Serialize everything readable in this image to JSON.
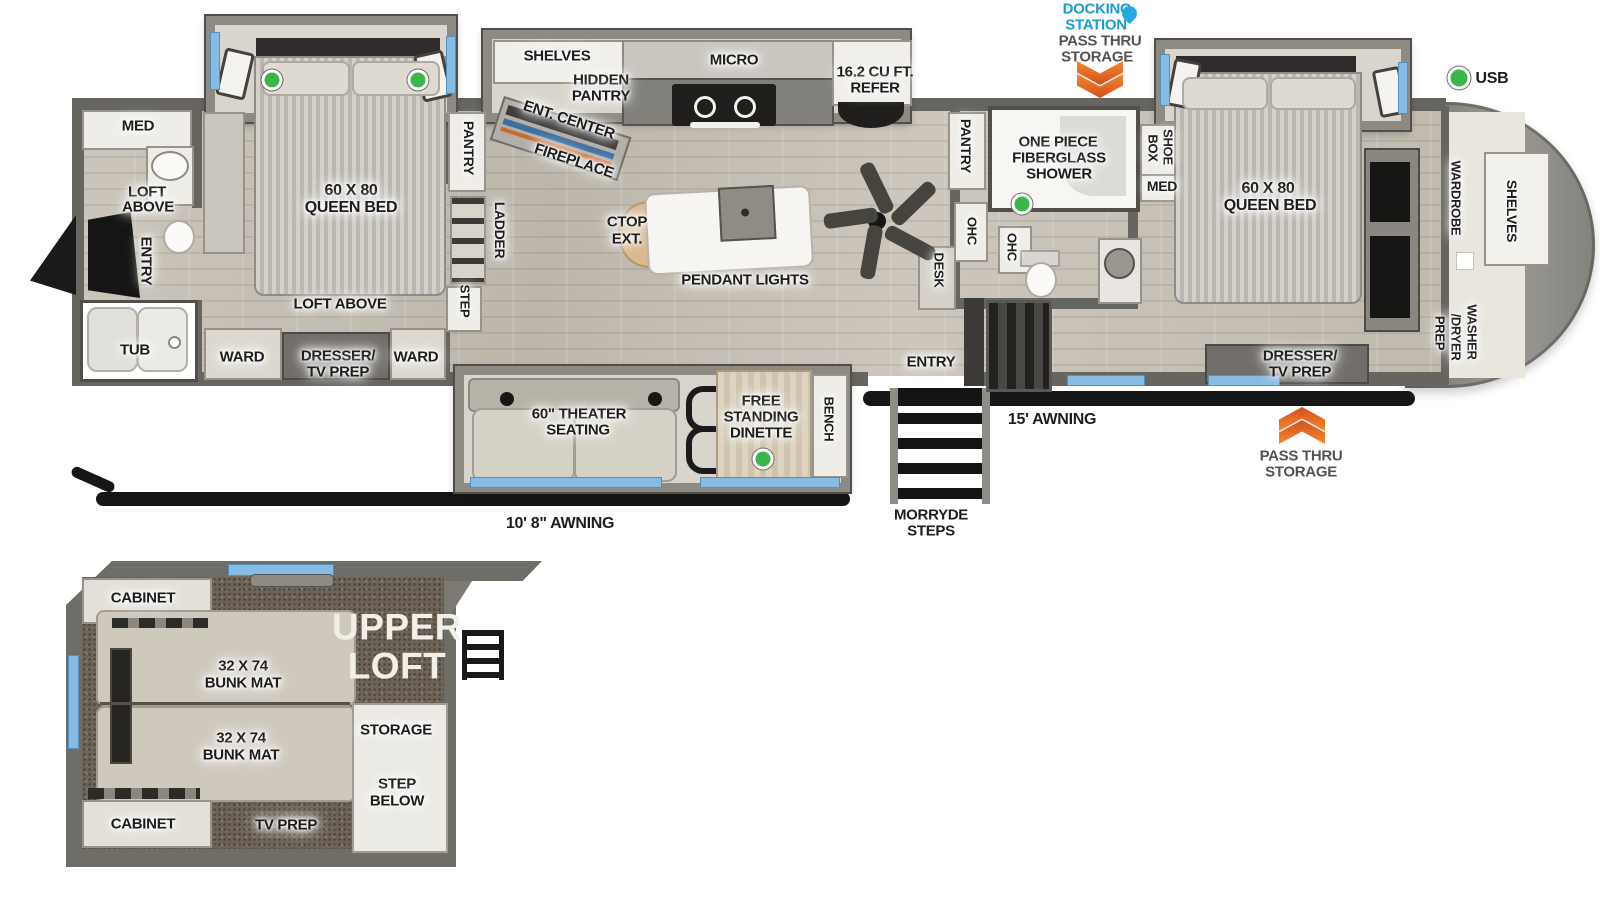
{
  "colors": {
    "accent_blue": "#1b9ad2",
    "arrow_orange": "#e8641b",
    "indicator_green": "#3cb54a",
    "window_blue": "#86bce4"
  },
  "top_annotations": {
    "docking_l1": "DOCKING",
    "docking_l2": "STATION",
    "pass_thru_l1": "PASS THRU",
    "pass_thru_l2": "STORAGE",
    "usb": "USB"
  },
  "rear_bath": {
    "med": "MED",
    "loft_l1": "LOFT",
    "loft_l2": "ABOVE",
    "entry": "ENTRY",
    "tub": "TUB"
  },
  "bedroom2": {
    "bed_l1": "60 X 80",
    "bed_l2": "QUEEN BED",
    "loft_above": "LOFT ABOVE",
    "ward_left": "WARD",
    "dresser_l1": "DRESSER/",
    "dresser_l2": "TV PREP",
    "ward_right": "WARD"
  },
  "kitchen": {
    "pantry": "PANTRY",
    "ladder": "LADDER",
    "step": "STEP",
    "shelves": "SHELVES",
    "hidden_l1": "HIDDEN",
    "hidden_l2": "PANTRY",
    "ent_center": "ENT. CENTER",
    "fireplace": "FIREPLACE",
    "micro": "MICRO",
    "refer_l1": "16.2 CU FT.",
    "refer_l2": "REFER",
    "ctop_l1": "CTOP",
    "ctop_l2": "EXT.",
    "pendant": "PENDANT LIGHTS"
  },
  "mid_bath": {
    "pantry": "PANTRY",
    "ohc1": "OHC",
    "ohc2": "OHC",
    "desk": "DESK",
    "shower_l1": "ONE PIECE",
    "shower_l2": "FIBERGLASS",
    "shower_l3": "SHOWER",
    "shoe_l1": "SHOE",
    "shoe_l2": "BOX",
    "med": "MED"
  },
  "master": {
    "bed_l1": "60 X 80",
    "bed_l2": "QUEEN BED",
    "dresser_l1": "DRESSER/",
    "dresser_l2": "TV PREP",
    "wardrobe": "WARDROBE",
    "shelves": "SHELVES",
    "washer_l1": "WASHER",
    "washer_l2": "/DRYER",
    "washer_l3": "PREP"
  },
  "living": {
    "theater_l1": "60\" THEATER",
    "theater_l2": "SEATING",
    "dinette_l1": "FREE",
    "dinette_l2": "STANDING",
    "dinette_l3": "DINETTE",
    "bench": "BENCH"
  },
  "exterior": {
    "entry": "ENTRY",
    "morryde_l1": "MORRYDE",
    "morryde_l2": "STEPS",
    "awning_15": "15' AWNING",
    "awning_10_8": "10' 8\" AWNING",
    "pass_thru_l1": "PASS THRU",
    "pass_thru_l2": "STORAGE"
  },
  "loft": {
    "cabinet_top": "CABINET",
    "bunk1_l1": "32 X 74",
    "bunk1_l2": "BUNK MAT",
    "bunk2_l1": "32 X 74",
    "bunk2_l2": "BUNK MAT",
    "upper_l1": "UPPER",
    "upper_l2": "LOFT",
    "storage": "STORAGE",
    "step_l1": "STEP",
    "step_l2": "BELOW",
    "cabinet_bottom": "CABINET",
    "tv_prep": "TV PREP"
  }
}
